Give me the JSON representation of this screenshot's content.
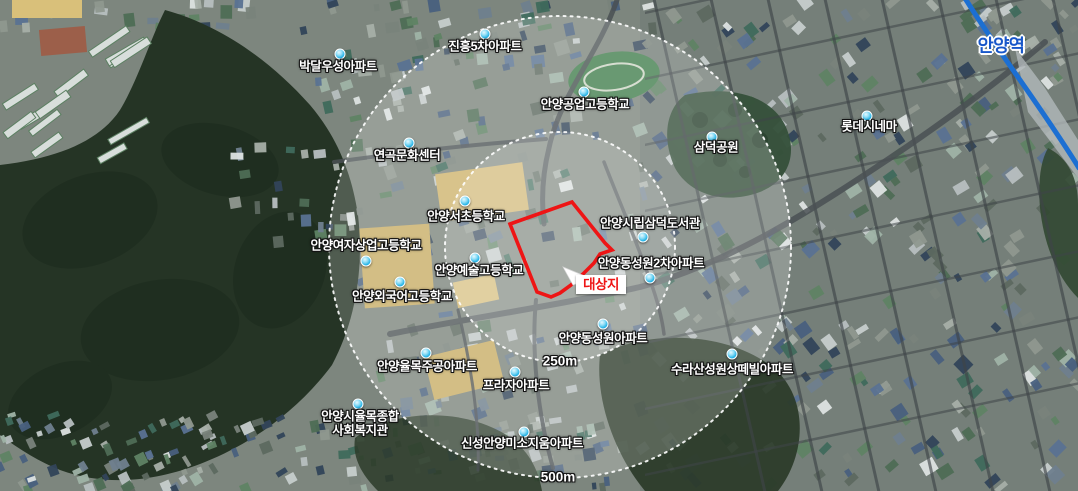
{
  "colors": {
    "site_red": "#ee1515",
    "marker_cyan": "#21b2e6",
    "railway_blue": "#1c6fd2",
    "station_blue": "#1857c9",
    "label_text": "#ffffff"
  },
  "map": {
    "labels": [
      {
        "id": "jinheung-5cha-apt",
        "text": "진흥5차아파트",
        "x": 485,
        "y": 47,
        "dot": {
          "x": 485,
          "y": 34
        }
      },
      {
        "id": "bakdal-wooseong-apt",
        "text": "박달우성아파트",
        "x": 338,
        "y": 67,
        "dot": {
          "x": 340,
          "y": 54
        }
      },
      {
        "id": "anyang-technical-high-school",
        "text": "안양공업고등학교",
        "x": 585,
        "y": 105,
        "dot": {
          "x": 584,
          "y": 92
        }
      },
      {
        "id": "lotte-cinema",
        "text": "롯데시네마",
        "x": 869,
        "y": 127,
        "dot": {
          "x": 867,
          "y": 116
        }
      },
      {
        "id": "samdeok-park",
        "text": "삼덕공원",
        "x": 716,
        "y": 148,
        "dot": {
          "x": 712,
          "y": 137
        }
      },
      {
        "id": "yeongok-culture-center",
        "text": "연곡문화센터",
        "x": 407,
        "y": 156,
        "dot": {
          "x": 409,
          "y": 143
        }
      },
      {
        "id": "anyang-seo-elementary-school",
        "text": "안양서초등학교",
        "x": 466,
        "y": 217,
        "dot": {
          "x": 465,
          "y": 201
        }
      },
      {
        "id": "anyang-samdeok-city-library",
        "text": "안양시립삼덕도서관",
        "x": 650,
        "y": 224,
        "dot": {
          "x": 643,
          "y": 237
        }
      },
      {
        "id": "anyang-girls-commercial-high-school",
        "text": "안양여자상업고등학교",
        "x": 366,
        "y": 246,
        "dot": {
          "x": 366,
          "y": 261
        }
      },
      {
        "id": "anyang-arts-high-school",
        "text": "안양예술고등학교",
        "x": 479,
        "y": 271,
        "dot": {
          "x": 475,
          "y": 258
        }
      },
      {
        "id": "anyang-dongsungwon-2cha-apt",
        "text": "안양동성원2차아파트",
        "x": 651,
        "y": 264,
        "dot": {
          "x": 650,
          "y": 278
        }
      },
      {
        "id": "anyang-foreign-language-high-school",
        "text": "안양외국어고등학교",
        "x": 402,
        "y": 297,
        "dot": {
          "x": 400,
          "y": 282
        }
      },
      {
        "id": "anyang-dongsungwon-apt",
        "text": "안양동성원아파트",
        "x": 603,
        "y": 339,
        "dot": {
          "x": 603,
          "y": 324
        }
      },
      {
        "id": "anyang-yulmok-jugong-apt",
        "text": "안양율목주공아파트",
        "x": 427,
        "y": 367,
        "dot": {
          "x": 426,
          "y": 353
        }
      },
      {
        "id": "surasan-sungwon-santevill-apt",
        "text": "수라산성원상떼빌아파트",
        "x": 732,
        "y": 370,
        "dot": {
          "x": 732,
          "y": 354
        }
      },
      {
        "id": "plaza-apt",
        "text": "프라자아파트",
        "x": 516,
        "y": 386,
        "dot": {
          "x": 515,
          "y": 372
        }
      },
      {
        "id": "anyang-yulmok-welfare-center",
        "text": "안양시율목종합\n사회복지관",
        "x": 360,
        "y": 424,
        "dot": {
          "x": 358,
          "y": 404
        }
      },
      {
        "id": "shinsung-anyang-misozium-apt",
        "text": "신성안양미소지움아파트",
        "x": 522,
        "y": 444,
        "dot": {
          "x": 524,
          "y": 432
        }
      }
    ],
    "station": {
      "id": "anyang-station",
      "text": "안양역",
      "x": 1001,
      "y": 45
    },
    "scale_labels": [
      {
        "text": "250m",
        "x": 560,
        "y": 361
      },
      {
        "text": "500m",
        "x": 558,
        "y": 477
      }
    ],
    "callout": {
      "text": "대상지"
    }
  }
}
